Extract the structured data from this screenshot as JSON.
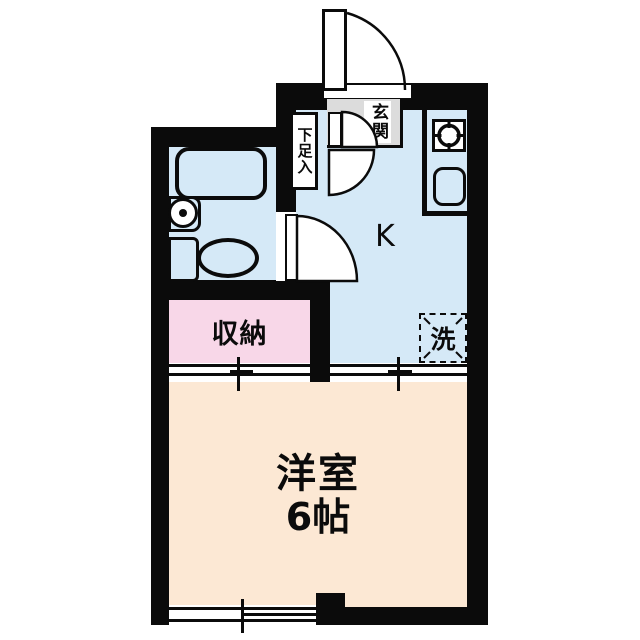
{
  "plan_type": "apartment-floorplan",
  "labels": {
    "kitchen": "K",
    "western_room_name": "洋室",
    "western_room_size": "6帖",
    "storage": "収納",
    "entrance": "玄関",
    "shoe_cabinet": "下足入",
    "washer": "洗"
  },
  "colors": {
    "wall": "#0b0b0b",
    "water_blue": "#d5e9f7",
    "cream": "#fce8d4",
    "pink": "#f8d7e8",
    "gray": "#dcdcdc",
    "white": "#ffffff"
  }
}
